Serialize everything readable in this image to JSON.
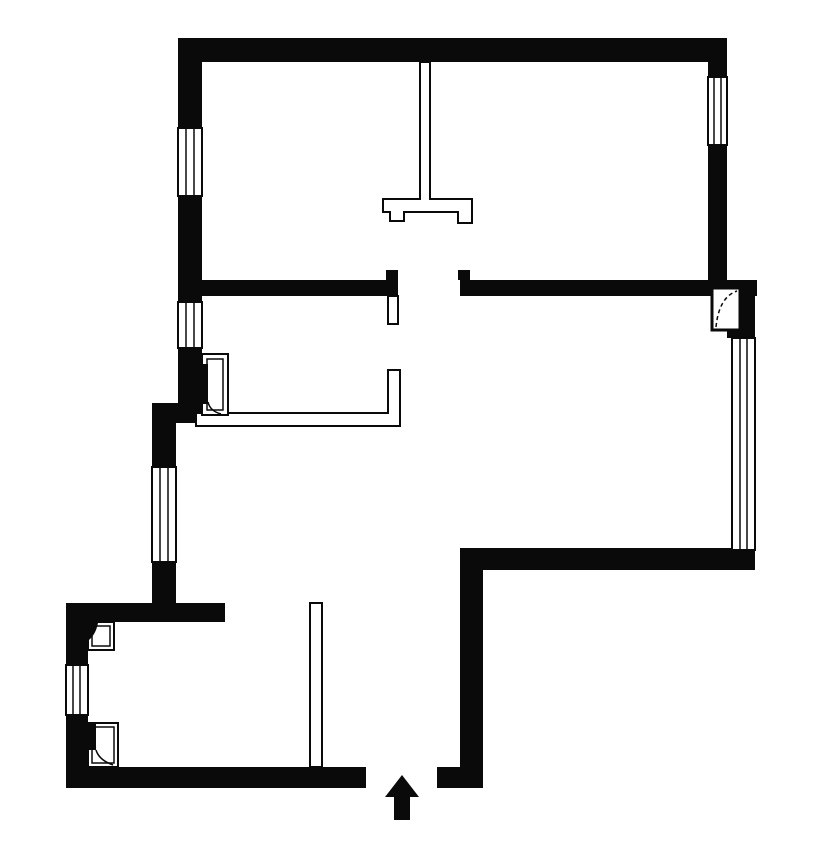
{
  "canvas": {
    "w": 826,
    "h": 843,
    "bg": "#ffffff",
    "ink": "#0a0a0a"
  },
  "layers": [
    "walls",
    "partitions",
    "windows",
    "doors",
    "symbols"
  ],
  "plan": {
    "walls": [
      {
        "name": "wall-top",
        "shapes": [
          {
            "t": "rect",
            "x": 178,
            "y": 38,
            "w": 549,
            "h": 24,
            "f": "ink"
          }
        ]
      },
      {
        "name": "wall-left-upper-a",
        "shapes": [
          {
            "t": "rect",
            "x": 178,
            "y": 38,
            "w": 24,
            "h": 90,
            "f": "ink"
          }
        ]
      },
      {
        "name": "wall-left-upper-b",
        "shapes": [
          {
            "t": "rect",
            "x": 178,
            "y": 196,
            "w": 24,
            "h": 106,
            "f": "ink"
          }
        ]
      },
      {
        "name": "wall-left-upper-c",
        "shapes": [
          {
            "t": "rect",
            "x": 178,
            "y": 348,
            "w": 24,
            "h": 75,
            "f": "ink"
          }
        ]
      },
      {
        "name": "wall-left-jog",
        "shapes": [
          {
            "t": "rect",
            "x": 152,
            "y": 403,
            "w": 50,
            "h": 20,
            "f": "ink"
          }
        ]
      },
      {
        "name": "wall-left-mid-a",
        "shapes": [
          {
            "t": "rect",
            "x": 152,
            "y": 423,
            "w": 24,
            "h": 44,
            "f": "ink"
          }
        ]
      },
      {
        "name": "wall-left-mid-b",
        "shapes": [
          {
            "t": "rect",
            "x": 152,
            "y": 562,
            "w": 24,
            "h": 60,
            "f": "ink"
          }
        ]
      },
      {
        "name": "wall-utility-top",
        "shapes": [
          {
            "t": "rect",
            "x": 66,
            "y": 603,
            "w": 159,
            "h": 19,
            "f": "ink"
          }
        ]
      },
      {
        "name": "wall-utility-left-a",
        "shapes": [
          {
            "t": "rect",
            "x": 66,
            "y": 603,
            "w": 22,
            "h": 62,
            "f": "ink"
          }
        ]
      },
      {
        "name": "wall-utility-left-b",
        "shapes": [
          {
            "t": "rect",
            "x": 66,
            "y": 715,
            "w": 22,
            "h": 73,
            "f": "ink"
          }
        ]
      },
      {
        "name": "wall-bottom",
        "shapes": [
          {
            "t": "rect",
            "x": 66,
            "y": 767,
            "w": 300,
            "h": 21,
            "f": "ink"
          }
        ]
      },
      {
        "name": "wall-entry-jamb",
        "shapes": [
          {
            "t": "rect",
            "x": 437,
            "y": 767,
            "w": 46,
            "h": 21,
            "f": "ink"
          }
        ]
      },
      {
        "name": "wall-hall-right",
        "shapes": [
          {
            "t": "rect",
            "x": 460,
            "y": 548,
            "w": 23,
            "h": 240,
            "f": "ink"
          }
        ]
      },
      {
        "name": "wall-living-bottom",
        "shapes": [
          {
            "t": "rect",
            "x": 460,
            "y": 548,
            "w": 295,
            "h": 22,
            "f": "ink"
          }
        ]
      },
      {
        "name": "wall-right-upper-a",
        "shapes": [
          {
            "t": "rect",
            "x": 708,
            "y": 62,
            "w": 19,
            "h": 15,
            "f": "ink"
          }
        ]
      },
      {
        "name": "wall-right-upper-b",
        "shapes": [
          {
            "t": "rect",
            "x": 708,
            "y": 145,
            "w": 19,
            "h": 135,
            "f": "ink"
          }
        ]
      },
      {
        "name": "wall-interior-west",
        "shapes": [
          {
            "t": "rect",
            "x": 202,
            "y": 280,
            "w": 196,
            "h": 16,
            "f": "ink"
          },
          {
            "t": "rect",
            "x": 386,
            "y": 270,
            "w": 12,
            "h": 10,
            "f": "ink"
          }
        ]
      },
      {
        "name": "wall-interior-east",
        "shapes": [
          {
            "t": "rect",
            "x": 460,
            "y": 280,
            "w": 297,
            "h": 16,
            "f": "ink"
          },
          {
            "t": "rect",
            "x": 458,
            "y": 270,
            "w": 12,
            "h": 10,
            "f": "ink"
          }
        ]
      },
      {
        "name": "wall-right-corner",
        "shapes": [
          {
            "t": "rect",
            "x": 727,
            "y": 280,
            "w": 28,
            "h": 58,
            "f": "ink"
          }
        ]
      }
    ],
    "partitions": [
      {
        "name": "partition-upper-rooms",
        "shapes": [
          {
            "t": "path",
            "d": "M420,62 L430,62 L430,199 L472,199 L472,223 L458,223 L458,212 L404,212 L404,221 L390,221 L390,212 L383,212 L383,199 L420,199 Z",
            "f": "bg",
            "sw": 2
          }
        ]
      },
      {
        "name": "partition-kitchen",
        "shapes": [
          {
            "t": "path",
            "d": "M196,413 L388,413 L388,370 L400,370 L400,426 L196,426 Z",
            "f": "bg",
            "sw": 2
          }
        ]
      },
      {
        "name": "partition-utility",
        "shapes": [
          {
            "t": "rect",
            "x": 310,
            "y": 603,
            "w": 12,
            "h": 164,
            "f": "bg",
            "sw": 2
          }
        ]
      }
    ],
    "windows": [
      {
        "name": "window-northwest-upper",
        "shapes": [
          {
            "t": "rect",
            "x": 178,
            "y": 128,
            "w": 24,
            "h": 68,
            "f": "bg",
            "sw": 2
          },
          {
            "t": "line",
            "x1": 186,
            "y1": 128,
            "x2": 186,
            "y2": 196,
            "sw": 1.5
          },
          {
            "t": "line",
            "x1": 194,
            "y1": 128,
            "x2": 194,
            "y2": 196,
            "sw": 1.5
          }
        ]
      },
      {
        "name": "window-northwest-lower",
        "shapes": [
          {
            "t": "rect",
            "x": 178,
            "y": 302,
            "w": 24,
            "h": 46,
            "f": "bg",
            "sw": 2
          },
          {
            "t": "line",
            "x1": 186,
            "y1": 302,
            "x2": 186,
            "y2": 348,
            "sw": 1.5
          },
          {
            "t": "line",
            "x1": 194,
            "y1": 302,
            "x2": 194,
            "y2": 348,
            "sw": 1.5
          }
        ]
      },
      {
        "name": "window-west",
        "shapes": [
          {
            "t": "rect",
            "x": 152,
            "y": 467,
            "w": 24,
            "h": 95,
            "f": "bg",
            "sw": 2
          },
          {
            "t": "line",
            "x1": 160,
            "y1": 467,
            "x2": 160,
            "y2": 562,
            "sw": 1.5
          },
          {
            "t": "line",
            "x1": 168,
            "y1": 467,
            "x2": 168,
            "y2": 562,
            "sw": 1.5
          }
        ]
      },
      {
        "name": "window-utility",
        "shapes": [
          {
            "t": "rect",
            "x": 66,
            "y": 665,
            "w": 22,
            "h": 50,
            "f": "bg",
            "sw": 2
          },
          {
            "t": "line",
            "x1": 73,
            "y1": 665,
            "x2": 73,
            "y2": 715,
            "sw": 1.5
          },
          {
            "t": "line",
            "x1": 80,
            "y1": 665,
            "x2": 80,
            "y2": 715,
            "sw": 1.5
          }
        ]
      },
      {
        "name": "window-living-east",
        "shapes": [
          {
            "t": "rect",
            "x": 732,
            "y": 338,
            "w": 23,
            "h": 212,
            "f": "bg",
            "sw": 2
          },
          {
            "t": "line",
            "x1": 740,
            "y1": 338,
            "x2": 740,
            "y2": 550,
            "sw": 1.5
          },
          {
            "t": "line",
            "x1": 747,
            "y1": 338,
            "x2": 747,
            "y2": 550,
            "sw": 1.5
          }
        ]
      },
      {
        "name": "window-northeast",
        "shapes": [
          {
            "t": "rect",
            "x": 708,
            "y": 77,
            "w": 19,
            "h": 68,
            "f": "bg",
            "sw": 2
          },
          {
            "t": "line",
            "x1": 714,
            "y1": 77,
            "x2": 714,
            "y2": 145,
            "sw": 1.5
          },
          {
            "t": "line",
            "x1": 721,
            "y1": 77,
            "x2": 721,
            "y2": 145,
            "sw": 1.5
          }
        ]
      }
    ],
    "doors": [
      {
        "name": "door-kitchen",
        "shapes": [
          {
            "t": "rect",
            "x": 202,
            "y": 354,
            "w": 26,
            "h": 61,
            "f": "bg",
            "sw": 2
          },
          {
            "t": "rect",
            "x": 207,
            "y": 359,
            "w": 16,
            "h": 51,
            "f": "none",
            "sw": 1.5
          },
          {
            "t": "rect",
            "x": 202,
            "y": 364,
            "w": 6,
            "h": 40,
            "f": "ink"
          },
          {
            "t": "path",
            "d": "M208,402 Q210,411 221,414",
            "f": "none",
            "sw": 1.5
          }
        ]
      },
      {
        "name": "door-utility-inner",
        "shapes": [
          {
            "t": "rect",
            "x": 88,
            "y": 622,
            "w": 26,
            "h": 28,
            "f": "bg",
            "sw": 2
          },
          {
            "t": "rect",
            "x": 92,
            "y": 626,
            "w": 18,
            "h": 20,
            "f": "none",
            "sw": 1.5
          },
          {
            "t": "path",
            "d": "M89,623 L98,623 Q96,634 89,640 Z",
            "f": "ink"
          }
        ]
      },
      {
        "name": "door-utility-outer",
        "shapes": [
          {
            "t": "rect",
            "x": 88,
            "y": 723,
            "w": 30,
            "h": 44,
            "f": "bg",
            "sw": 2
          },
          {
            "t": "rect",
            "x": 92,
            "y": 727,
            "w": 22,
            "h": 36,
            "f": "none",
            "sw": 1.5
          },
          {
            "t": "rect",
            "x": 89,
            "y": 724,
            "w": 7,
            "h": 26,
            "f": "ink"
          },
          {
            "t": "path",
            "d": "M96,750 Q99,760 113,765",
            "f": "none",
            "sw": 1.5
          }
        ]
      },
      {
        "name": "door-living",
        "shapes": [
          {
            "t": "rect",
            "x": 712,
            "y": 288,
            "w": 28,
            "h": 42,
            "f": "bg",
            "sw": 3
          },
          {
            "t": "path",
            "d": "M716,327 Q719,297 737,291",
            "f": "none",
            "sw": 1.5,
            "dash": "4 3"
          }
        ]
      },
      {
        "name": "door-leaf-corridor",
        "shapes": [
          {
            "t": "rect",
            "x": 388,
            "y": 296,
            "w": 10,
            "h": 28,
            "f": "bg",
            "sw": 2
          }
        ]
      }
    ],
    "symbols": [
      {
        "name": "entry-arrow",
        "shapes": [
          {
            "t": "polygon",
            "pts": "402,775 419,797 410,797 410,820 394,820 394,797 385,797",
            "f": "ink"
          }
        ]
      }
    ]
  }
}
